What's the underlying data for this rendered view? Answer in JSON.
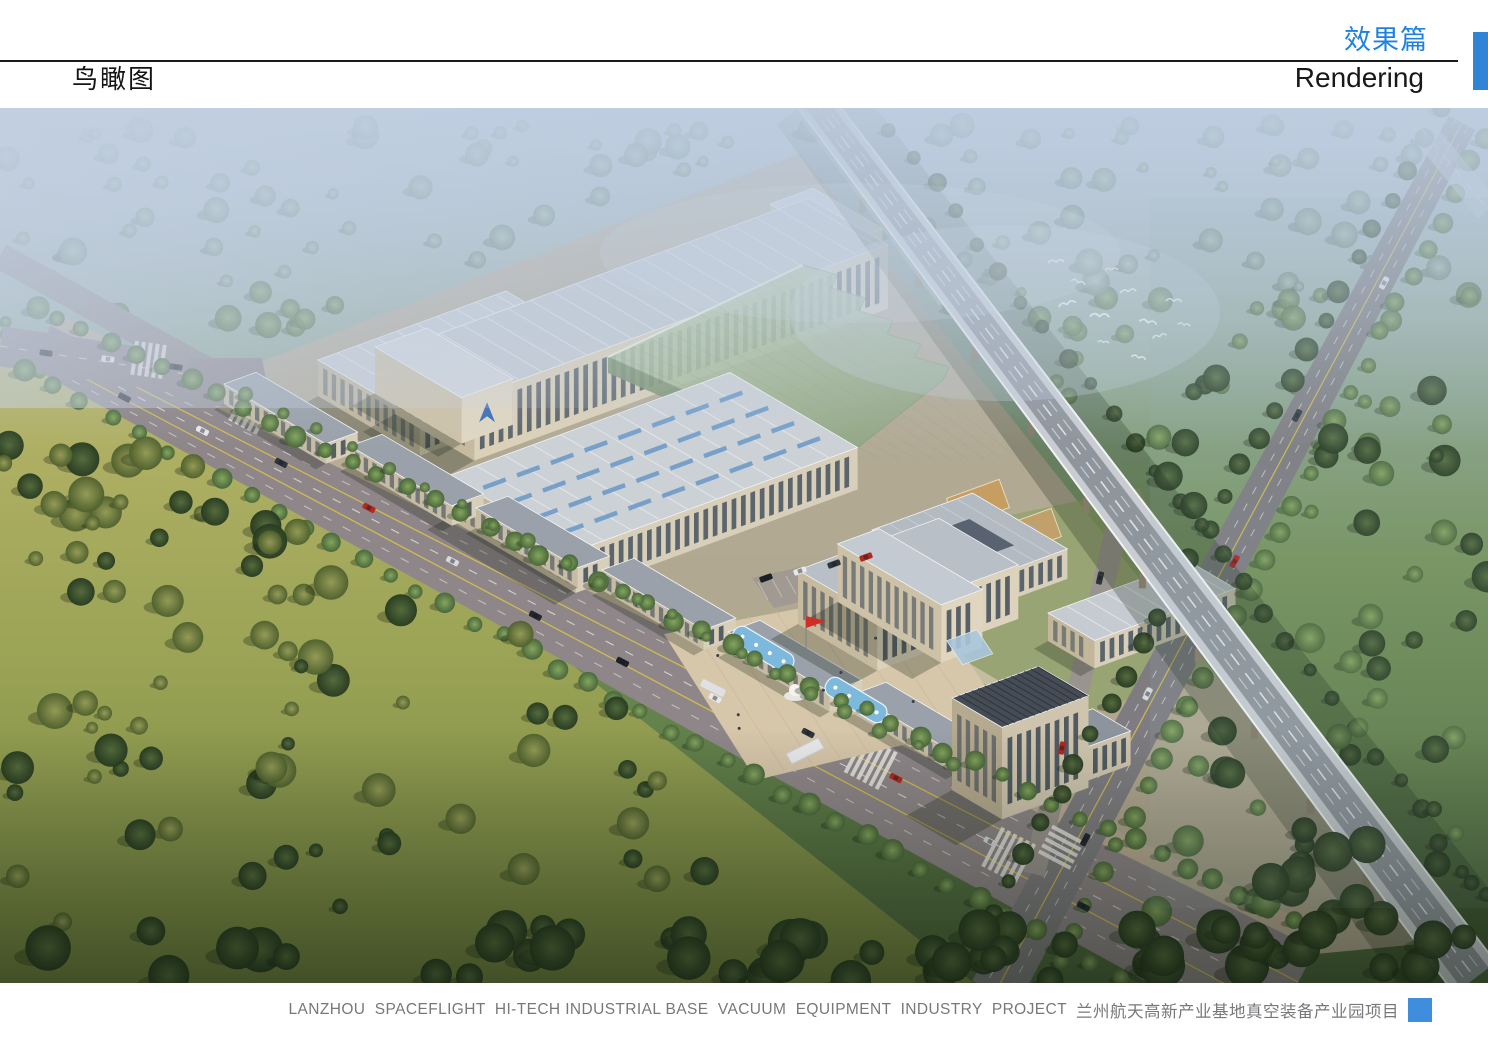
{
  "header": {
    "view_title": "鸟瞰图",
    "section_title_zh": "效果篇",
    "section_title_en": "Rendering"
  },
  "footer": {
    "caption_en": "LANZHOU  SPACEFLIGHT  HI-TECH INDUSTRIAL BASE  VACUUM  EQUIPMENT  INDUSTRY  PROJECT",
    "caption_zh": "兰州航天高新产业基地真空装备产业园项目"
  },
  "colors": {
    "accent_blue": "#1f82e0",
    "accent_block_blue": "#2f84d6",
    "header_rule": "#1a1a1a",
    "caption_gray": "#77787b",
    "caption_marker_blue": "#3f8edd",
    "logo_blue": "#3c6cb4",
    "pool_blue": "#7db9dc",
    "flag_red": "#cf2e27"
  },
  "scene": {
    "kind": "aerial-architectural-rendering",
    "subject": "Industrial park campus: factory halls, green glass workshop, courtyard office, high-rise tower, fountain plaza, elevated expressway, tree-lined boulevards, meadows and forest"
  }
}
